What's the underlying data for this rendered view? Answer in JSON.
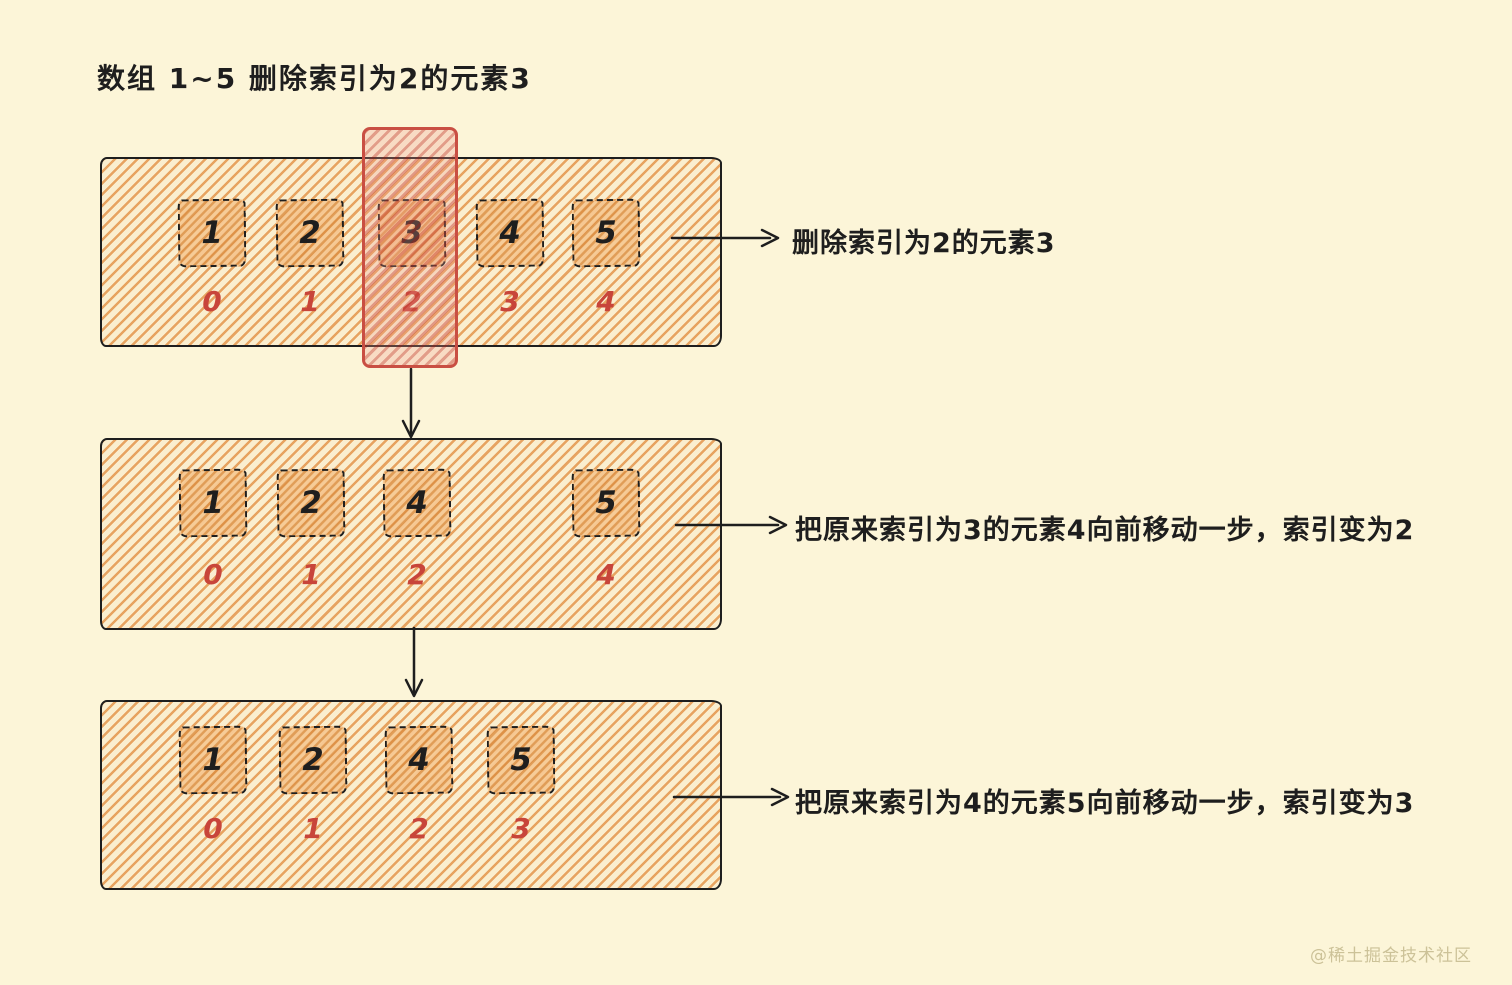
{
  "page": {
    "title": "数组 1~5 删除索引为2的元素3",
    "watermark": "@稀土掘金技术社区",
    "colors": {
      "background": "#FCF5D8",
      "hatch_orange": "#E7A360",
      "cell_orange": "#DB8E42",
      "index_red": "#C8453A",
      "highlight_red": "#C94F43",
      "ink": "#1E1E1E"
    }
  },
  "steps": [
    {
      "label": "删除索引为2的元素3",
      "cells": [
        {
          "value": "1",
          "index": "0"
        },
        {
          "value": "2",
          "index": "1"
        },
        {
          "value": "3",
          "index": "2",
          "highlighted": true
        },
        {
          "value": "4",
          "index": "3"
        },
        {
          "value": "5",
          "index": "4"
        }
      ]
    },
    {
      "label": "把原来索引为3的元素4向前移动一步，索引变为2",
      "cells": [
        {
          "value": "1",
          "index": "0"
        },
        {
          "value": "2",
          "index": "1"
        },
        {
          "value": "4",
          "index": "2"
        },
        {
          "empty": true
        },
        {
          "value": "5",
          "index": "4"
        }
      ]
    },
    {
      "label": "把原来索引为4的元素5向前移动一步，索引变为3",
      "cells": [
        {
          "value": "1",
          "index": "0"
        },
        {
          "value": "2",
          "index": "1"
        },
        {
          "value": "4",
          "index": "2"
        },
        {
          "value": "5",
          "index": "3"
        }
      ]
    }
  ]
}
